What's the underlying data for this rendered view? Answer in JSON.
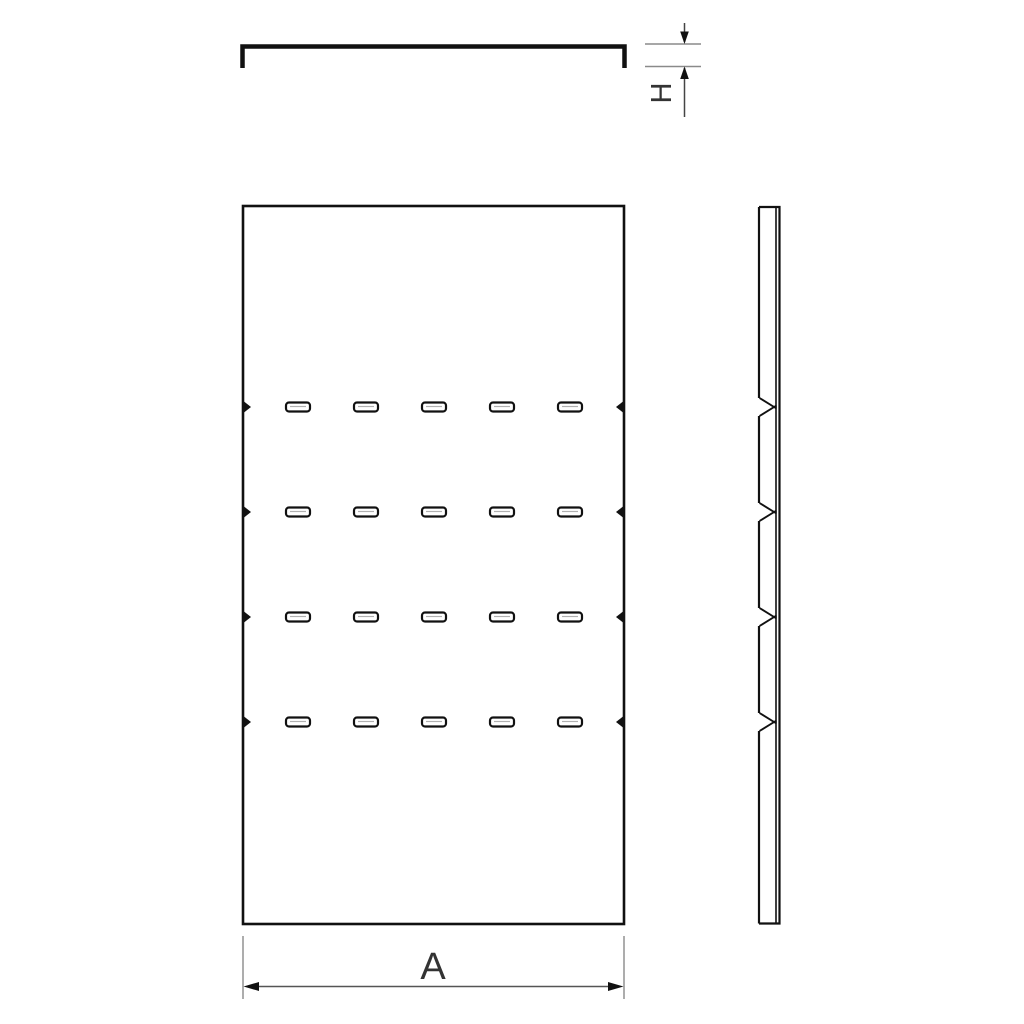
{
  "page": {
    "background": "#ffffff",
    "line_color": "#111111",
    "dim_line_color": "#555555",
    "ext_line_color": "#8a8a8a",
    "slot_highlight_color": "#b0b0b0"
  },
  "dimensions": {
    "width_label": "A",
    "thickness_label": "H"
  },
  "front_view": {
    "slot_rows": 4,
    "slot_columns": 5
  },
  "side_view": {
    "notch_count": 4
  }
}
